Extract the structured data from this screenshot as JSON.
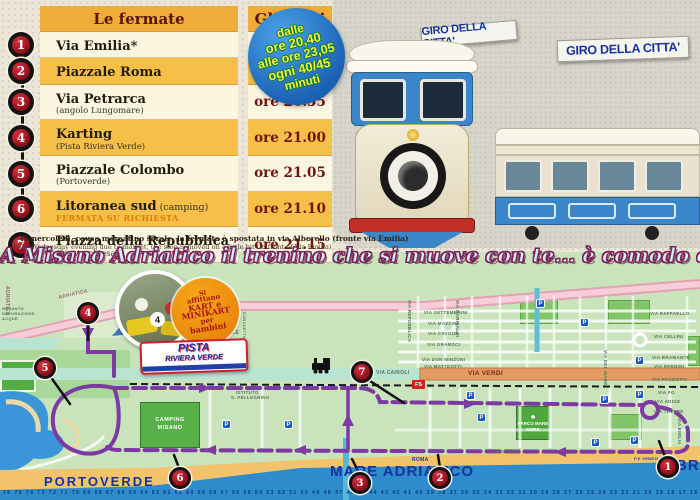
{
  "timetable": {
    "header": {
      "stops": "Le fermate",
      "times": "Gli orari"
    },
    "rows": [
      {
        "n": "1",
        "name": "Via Emilia*",
        "sub": "",
        "inline": false,
        "note": "",
        "time": "ore 20.40"
      },
      {
        "n": "2",
        "name": "Piazzale Roma",
        "sub": "",
        "inline": false,
        "note": "",
        "time": "ore 20.50"
      },
      {
        "n": "3",
        "name": "Via Petrarca",
        "sub": "(angolo Lungomare)",
        "inline": false,
        "note": "",
        "time": "ore 20.55"
      },
      {
        "n": "4",
        "name": "Karting",
        "sub": "(Pista Riviera Verde)",
        "inline": false,
        "note": "",
        "time": "ore 21.00"
      },
      {
        "n": "5",
        "name": "Piazzale Colombo",
        "sub": "(Portoverde)",
        "inline": false,
        "note": "",
        "time": "ore 21.05"
      },
      {
        "n": "6",
        "name": "Litoranea sud",
        "sub": "(camping)",
        "inline": true,
        "note": "FERMATA SU RICHIESTA",
        "time": "ore 21.10"
      },
      {
        "n": "7",
        "name": "Piazza della Repubblica",
        "sub": "(fronte chiesa)",
        "inline": false,
        "note": "",
        "time": "ore 21.15"
      }
    ],
    "footnote_it": "* Il mercoledì, causa mercatino serale, la fermata è spostata in via Alberello (fronte via Emilia)",
    "footnote_en": "* On Wednesday evening due to market, the stop is moved on a little bit (in front of Via Emilia)"
  },
  "schedule_badge": {
    "lines": [
      "dalle",
      "ore 20,40",
      "alle ore 23,05",
      "ogni 40/45",
      "minuti"
    ]
  },
  "train_photo": {
    "sign1": "GIRO DELLA CITTA'",
    "sign2": "GIRO DELLA CITTA'"
  },
  "notice": {
    "it": [
      "Gli orari potrebbero subire delle variazioni",
      "a causa del traffico o delle condizioni meteorologiche.",
      "La Direzione si scusa per l'inconveniente."
    ],
    "en": [
      "Times may change due to traffic and weather conditions.",
      "The management apologizes for the inconvenience."
    ]
  },
  "banner": "A Misano Adriatico il trenino che si muove con te... è comodo e divertente!",
  "map": {
    "kart_badge": [
      "Si",
      "affittano",
      "KART e",
      "MINIKART",
      "per",
      "bambini"
    ],
    "kart_photo_number": "4",
    "pista_logo": {
      "line1": "PISTA",
      "line2": "RIVIERA VERDE"
    },
    "camping_line1": "CAMPING",
    "camping_line2": "MISANO",
    "parco": "PARCO MARE NORD",
    "fs_label": "FS",
    "parking_letter": "P",
    "sea_label": "MARE ADRIATICO",
    "portoverde_label": "PORTOVERDE",
    "bras_label": "BRAS",
    "beach_numbers": "76 75 74 73 72 71 70 69 68 67 66 65 64 63 62 61 60 59 58 57 56 55 54 53 52 51 50 49 48 47 46 45 44 43 42 41 40 39 38 37 36 35 34 33 32 31 30 29 28 27 26 25 24 23 22 21 20 19 18 17 16 15 14 13 12 11 10 9 8 7 6 5 4 3",
    "labels": [
      [
        "ADRIATICA",
        58,
        295,
        -13,
        5,
        "p"
      ],
      [
        "ADRIATICA",
        10,
        286,
        90,
        5,
        "p"
      ],
      [
        "IMPIANTO",
        2,
        306,
        0,
        4,
        "g"
      ],
      [
        "DEPURAZIONE",
        2,
        311,
        0,
        4,
        "g"
      ],
      [
        "ACQUE",
        2,
        316,
        0,
        4,
        "g"
      ],
      [
        "COMMERCIALE",
        198,
        330,
        0,
        5,
        "g"
      ],
      [
        "CANALETTA",
        247,
        312,
        90,
        4,
        "g"
      ],
      [
        "ISTITUTO",
        236,
        390,
        0,
        4.5,
        "g"
      ],
      [
        "S. PELLEGRINO",
        231,
        395,
        0,
        4.5,
        "g"
      ],
      [
        "VIA CAIROLI",
        376,
        370,
        0,
        5,
        "g"
      ],
      [
        "VIA VERDI",
        468,
        370,
        0,
        6.5,
        "r"
      ],
      [
        "VIA SETTEMBRINI",
        424,
        310,
        0,
        4.5,
        "g"
      ],
      [
        "VIA MAZZINI",
        428,
        321,
        0,
        4.5,
        "g"
      ],
      [
        "VIA CAVOUR",
        428,
        331,
        0,
        4.5,
        "g"
      ],
      [
        "VIA GRAMSCI",
        427,
        342,
        0,
        4.5,
        "g"
      ],
      [
        "VIA DON MINZONI",
        422,
        357,
        0,
        4.5,
        "g"
      ],
      [
        "VIA MATTEOTTI",
        424,
        364,
        0,
        4.5,
        "g"
      ],
      [
        "VIA REPUBBLICA",
        412,
        300,
        90,
        4.5,
        "g"
      ],
      [
        "VIA GARIBALDI",
        460,
        300,
        90,
        4.5,
        "g"
      ],
      [
        "VIA DEL MARE",
        608,
        350,
        90,
        4.5,
        "g"
      ],
      [
        "VIA RAFFAELLO",
        650,
        311,
        0,
        4.5,
        "g"
      ],
      [
        "VIA CELLINI",
        654,
        334,
        0,
        4.5,
        "g"
      ],
      [
        "VIA BRAMANTE",
        652,
        355,
        0,
        4.5,
        "g"
      ],
      [
        "VIA BERNINI",
        654,
        364,
        0,
        4.5,
        "g"
      ],
      [
        "VIA PAGNOTTI",
        652,
        377,
        0,
        4.5,
        "g"
      ],
      [
        "VIA PO",
        658,
        390,
        0,
        4.5,
        "g"
      ],
      [
        "VIA ADIGE",
        655,
        399,
        0,
        4.5,
        "g"
      ],
      [
        "VIA TEVERE",
        654,
        409,
        0,
        4.5,
        "g"
      ],
      [
        "VIA EMILIA",
        682,
        418,
        90,
        4.5,
        "g"
      ],
      [
        "LEOPARDI",
        494,
        449,
        0,
        4.5,
        "g"
      ],
      [
        "ROMA",
        412,
        457,
        0,
        5,
        "b"
      ],
      [
        "P.E VENEZIA",
        634,
        456,
        0,
        4,
        "b"
      ]
    ],
    "stops": [
      {
        "n": "1",
        "x": 668,
        "y": 467
      },
      {
        "n": "2",
        "x": 440,
        "y": 478
      },
      {
        "n": "3",
        "x": 360,
        "y": 483
      },
      {
        "n": "4",
        "x": 88,
        "y": 313
      },
      {
        "n": "5",
        "x": 45,
        "y": 368
      },
      {
        "n": "6",
        "x": 180,
        "y": 478
      },
      {
        "n": "7",
        "x": 362,
        "y": 372
      }
    ],
    "parkings": [
      [
        222,
        420
      ],
      [
        284,
        420
      ],
      [
        466,
        391
      ],
      [
        477,
        413
      ],
      [
        600,
        395
      ],
      [
        635,
        390
      ],
      [
        635,
        356
      ],
      [
        630,
        436
      ],
      [
        591,
        438
      ],
      [
        580,
        318
      ],
      [
        536,
        299
      ]
    ]
  },
  "colors": {
    "accent_purple": "#7c3aa2",
    "table_amber": "#f6bf48",
    "table_cream": "#fcf5e0",
    "sea_blue": "#2f8ccc",
    "badge_red": "#8a0e18"
  }
}
